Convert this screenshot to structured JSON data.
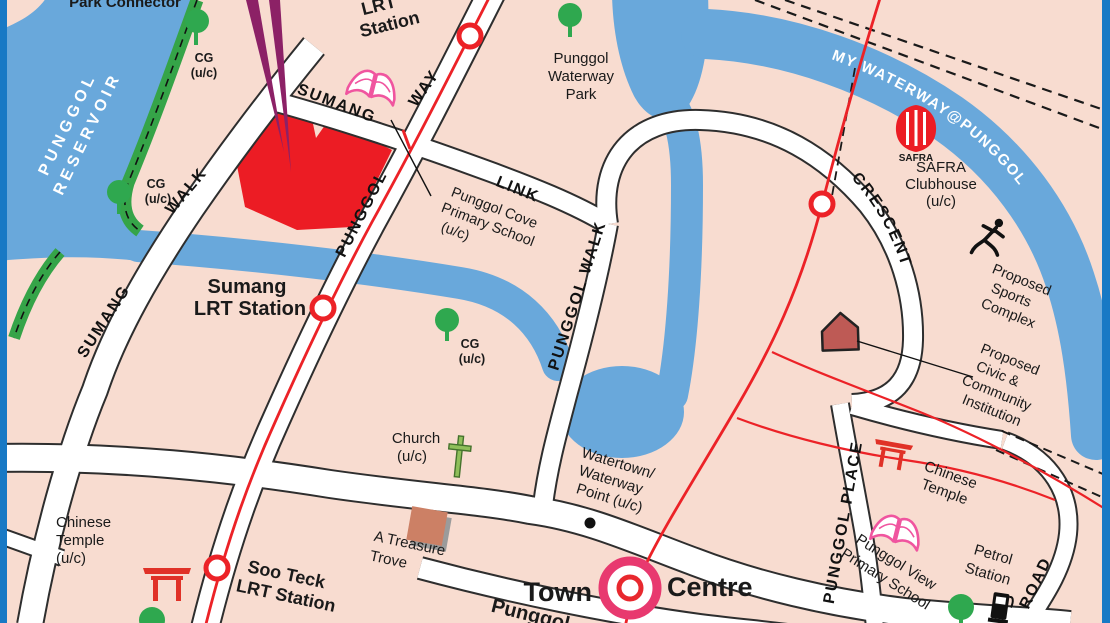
{
  "map_title": "Punggol area street map",
  "colors": {
    "water": "#69A8DB",
    "land": "#F8DCD0",
    "road_fill": "#FFFFFF",
    "road_casing": "#2E2E2E",
    "lrt_red": "#EC2227",
    "site_red": "#EC1C24",
    "arrow_purple": "#8C2166",
    "interchange_pink": "#E8396F",
    "park_green": "#35A448",
    "frame_blue": "#1879C5",
    "school_pink": "#F0559F",
    "temple_red": "#E03127",
    "house_red": "#BE5A55",
    "building_brown": "#CC8065"
  },
  "labels": {
    "park_connector": "Park Connector",
    "reservoir_1": "PUNGGOL",
    "reservoir_2": "RESERVOIR",
    "cg": "CG",
    "uc": "(u/c)",
    "nibong_1": "Nibong",
    "nibong_2": "LRT",
    "nibong_3": "Station",
    "sumang_station_1": "Sumang",
    "sumang_station_2": "LRT Station",
    "soo_teck_1": "Soo Teck",
    "soo_teck_2": "LRT Station",
    "road_sumang": "SUMANG",
    "road_walk": "WALK",
    "road_link": "LINK",
    "road_way": "WAY",
    "road_punggol": "PUNGGOL",
    "road_punggol_walk": "PUNGGOL WALK",
    "road_crescent": "CRESCENT",
    "road_punggol_place": "PUNGGOL PLACE",
    "road_road": "ROAD",
    "waterway_banner": "MY WATERWAY@PUNGGOL",
    "waterway_park_1": "Punggol",
    "waterway_park_2": "Waterway",
    "waterway_park_3": "Park",
    "cove_school_1": "Punggol Cove",
    "cove_school_2": "Primary School",
    "safra_logo": "SAFRA",
    "safra_1": "SAFRA",
    "safra_2": "Clubhouse",
    "proposed": "Proposed",
    "sports_2": "Sports",
    "sports_3": "Complex",
    "civic_2": "Civic &",
    "civic_3": "Community",
    "civic_4": "Institution",
    "chinese_1": "Chinese",
    "chinese_2": "Temple",
    "church_1": "Church",
    "treasure_1": "A Treasure",
    "treasure_2": "Trove",
    "watertown_1": "Watertown/",
    "watertown_2": "Waterway",
    "watertown_3": "Point (u/c)",
    "town_1": "Town",
    "town_2": "Centre",
    "punggol_cut": "Punggol",
    "petrol_1": "Petrol",
    "petrol_2": "Station",
    "view_school_1": "Punggol View",
    "view_school_2": "Primary School"
  }
}
